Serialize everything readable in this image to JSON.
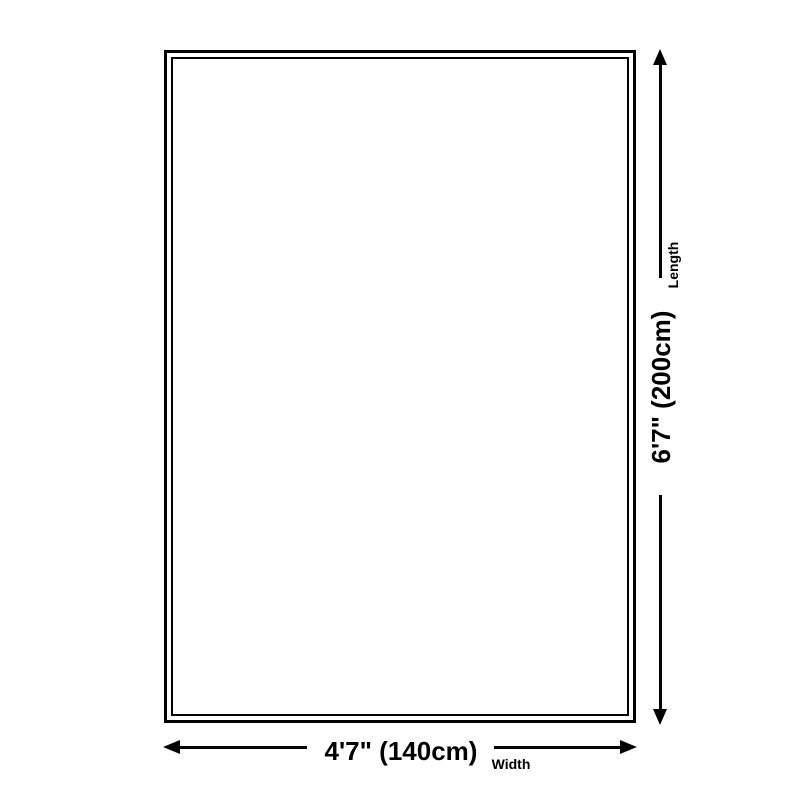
{
  "diagram": {
    "length": {
      "value": "6'7\" (200cm)",
      "label": "Length"
    },
    "width": {
      "value": "4'7\" (140cm)",
      "label": "Width"
    },
    "colors": {
      "line": "#000000",
      "background": "#ffffff"
    }
  }
}
